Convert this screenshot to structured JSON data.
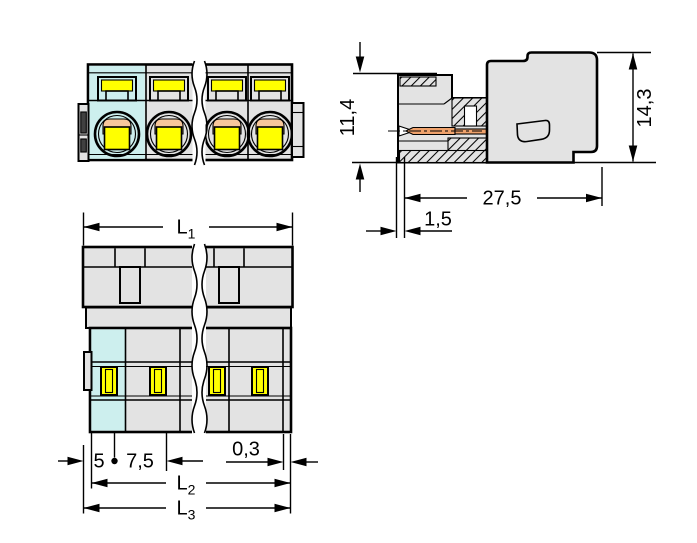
{
  "drawing": {
    "dims": {
      "socket_height": "11,4",
      "total_height": "14,3",
      "body_length": "27,5",
      "pin_setback": "1,5",
      "edge_to_pole": "5",
      "pole_pitch": "7,5",
      "end_gap": "0,3",
      "l1": {
        "base": "L",
        "sub": "1"
      },
      "l2": {
        "base": "L",
        "sub": "2"
      },
      "l3": {
        "base": "L",
        "sub": "3"
      }
    }
  },
  "colors": {
    "background": "#ffffff",
    "body_gray": "#e3e3e3",
    "cell_cyan": "#cdefee",
    "contact_yellow": "#ffff00",
    "contact_orange": "#f8c79b",
    "pin_orange": "#efa26c",
    "latch_dark": "#404040",
    "outline": "#000000"
  }
}
